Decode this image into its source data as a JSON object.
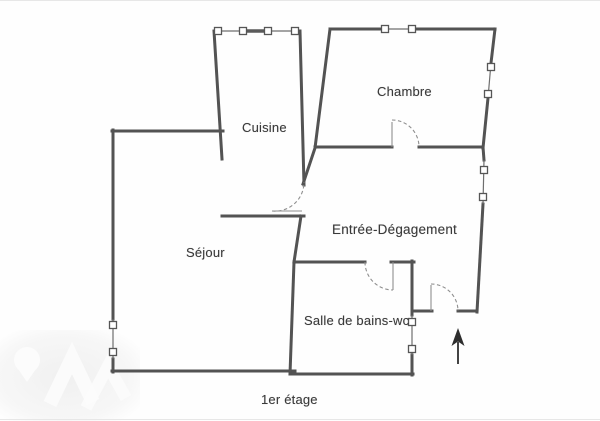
{
  "plan": {
    "rooms": {
      "cuisine": "Cuisine",
      "chambre": "Chambre",
      "sejour": "Séjour",
      "entree_degagement": "Entrée-Dégagement",
      "salle_de_bains_wc": "Salle de bains-wc"
    },
    "floor_label": "1er étage",
    "colors": {
      "wall": "#525252",
      "window_line": "#6e6e6e",
      "window_fill": "#ffffff",
      "door_swing": "#8f8f8f",
      "arrow": "#2f2f2f",
      "text": "#3a3a3a",
      "watermark": "#f1f1f1",
      "background": "#fefefe"
    },
    "icons": {
      "window": "window-icon",
      "door": "door-swing-icon",
      "arrow": "entrance-arrow-icon",
      "watermark": "watermark-logo"
    }
  }
}
